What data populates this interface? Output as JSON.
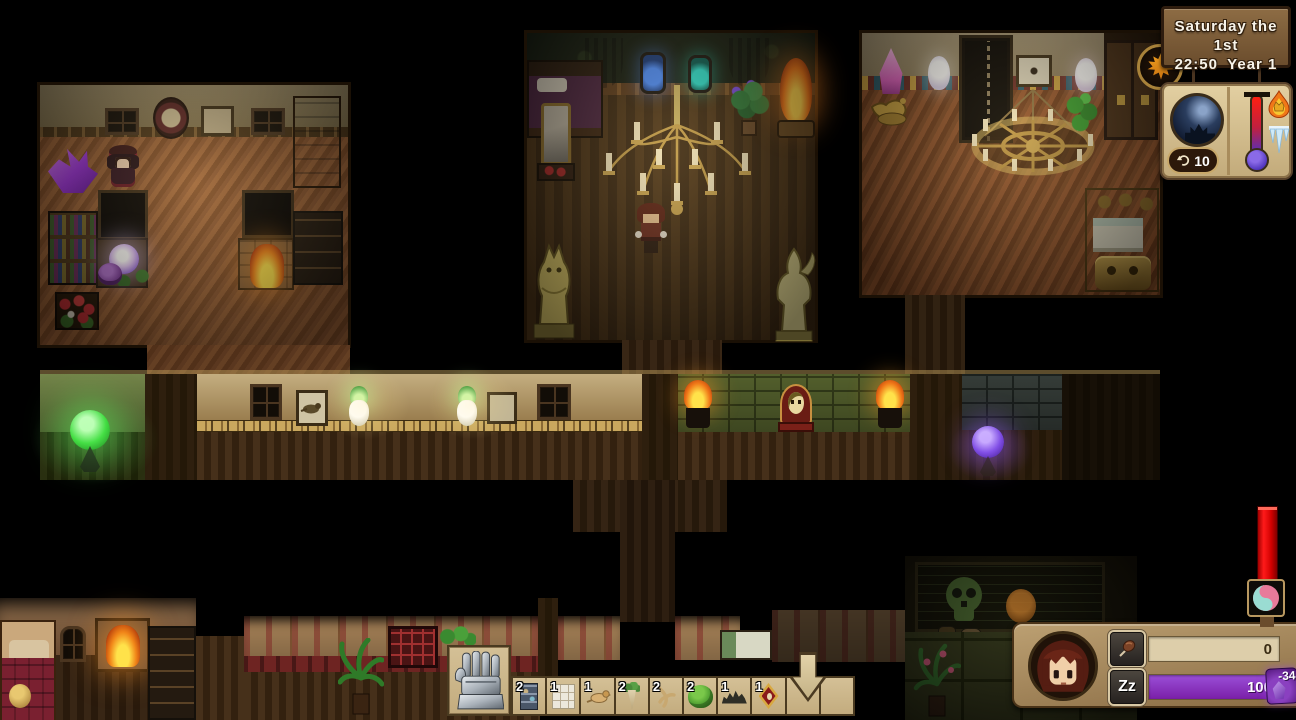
{
  "hud": {
    "datetime": {
      "date": "Saturday the 1st",
      "time": "22:50",
      "year": "Year 1"
    },
    "season": {
      "icon": "autumn-maple-leaf-icon"
    },
    "book": {
      "scene_icon": "night-castle-moon-icon",
      "counter": "10",
      "counter_icon": "undo-arrow-icon",
      "hot_icon": "flame-crown-icon",
      "cold_icon": "icicles-icon"
    },
    "temperature_gauge": {
      "icon": "yin-yang-swirl-icon",
      "color": "#e01010"
    },
    "status": {
      "portrait_icon": "player-face",
      "hunger": {
        "icon": "food-skewer-icon",
        "value": "0"
      },
      "energy": {
        "icon_text": "Zz",
        "value": "100",
        "delta": "-34",
        "bar_color": "#8a2bd0"
      }
    }
  },
  "hotbar": {
    "tool": {
      "icon": "gauntlet-glove-icon"
    },
    "drop_indicator_icon": "down-arrow-icon",
    "slots": [
      {
        "count": "2",
        "item": "display-shelf"
      },
      {
        "count": "1",
        "item": "window-frame"
      },
      {
        "count": "1",
        "item": "bird"
      },
      {
        "count": "2",
        "item": "mandrake-plant"
      },
      {
        "count": "2",
        "item": "root"
      },
      {
        "count": "2",
        "item": "bush"
      },
      {
        "count": "1",
        "item": "seed-pile"
      },
      {
        "count": "1",
        "item": "red-amulet"
      },
      {
        "count": "",
        "item": "empty"
      },
      {
        "count": "",
        "item": "empty"
      }
    ]
  },
  "colors": {
    "energy_bar": "#8a2bd0",
    "gauge_red": "#e01010",
    "panel_wood": "#b09467",
    "hotbar_tan": "#cdb88e"
  }
}
